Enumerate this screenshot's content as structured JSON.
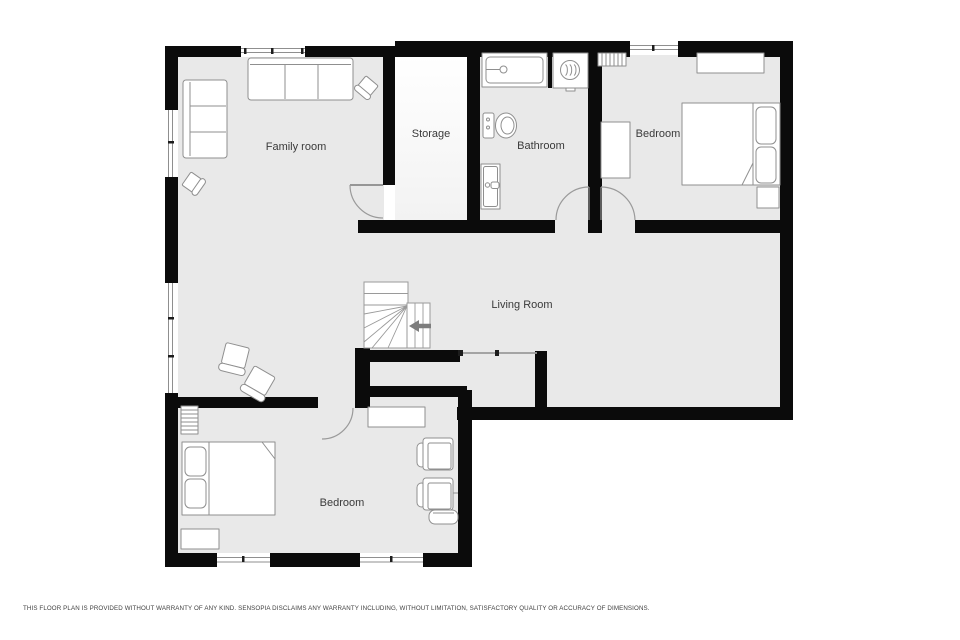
{
  "plan": {
    "colors": {
      "wall": "#0b0b0b",
      "floor": "#e9e9e9",
      "storage_floor_top": "#ffffff",
      "storage_floor_bottom": "#f2f2f2",
      "furniture_stroke": "#8f8f8f",
      "stair_arrow": "#7d7d7d",
      "label": "#3a3a3a"
    },
    "rooms": [
      {
        "id": "family-room",
        "label": "Family room"
      },
      {
        "id": "storage",
        "label": "Storage"
      },
      {
        "id": "bathroom",
        "label": "Bathroom"
      },
      {
        "id": "bedroom-top-right",
        "label": "Bedroom"
      },
      {
        "id": "living-room",
        "label": "Living Room"
      },
      {
        "id": "bedroom-bottom-left",
        "label": "Bedroom"
      }
    ],
    "furniture_icons": [
      "sofa",
      "loveseat",
      "speaker-chair",
      "armchair",
      "bed",
      "pillow",
      "nightstand",
      "dresser",
      "desk",
      "radiator",
      "bathtub",
      "toilet",
      "sink-vanity",
      "washer",
      "shelf",
      "ottoman",
      "staircase",
      "stair-direction-arrow",
      "door",
      "window"
    ]
  },
  "footer": {
    "disclaimer": "THIS FLOOR PLAN IS PROVIDED WITHOUT WARRANTY OF ANY KIND. SENSOPIA DISCLAIMS ANY WARRANTY INCLUDING, WITHOUT LIMITATION, SATISFACTORY QUALITY OR ACCURACY OF DIMENSIONS."
  }
}
